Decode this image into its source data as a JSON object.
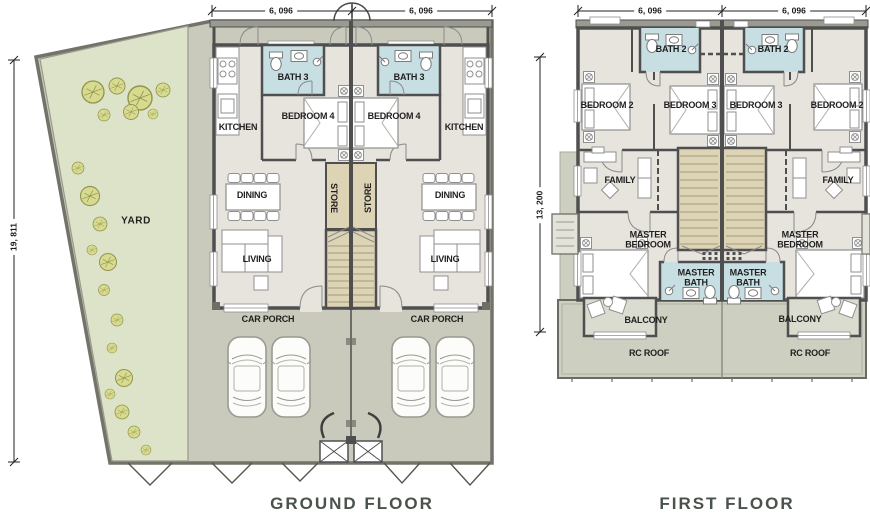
{
  "plans": {
    "ground": {
      "title": "GROUND FLOOR",
      "dim_width_left": "6, 096",
      "dim_width_right": "6, 096",
      "dim_depth": "19, 811",
      "rooms": {
        "yard": "YARD",
        "kitchen": "KITCHEN",
        "bath3": "BATH 3",
        "bedroom4": "BEDROOM 4",
        "dining": "DINING",
        "store": "STORE",
        "living": "LIVING",
        "car_porch": "CAR PORCH"
      }
    },
    "first": {
      "title": "FIRST FLOOR",
      "dim_width_left": "6, 096",
      "dim_width_right": "6, 096",
      "dim_depth": "13, 200",
      "rooms": {
        "bath2": "BATH 2",
        "bedroom2": "BEDROOM 2",
        "bedroom3": "BEDROOM 3",
        "family": "FAMILY",
        "master_bedroom": "MASTER BEDROOM",
        "master_bath": "MASTER BATH",
        "balcony": "BALCONY",
        "rc_roof": "RC ROOF"
      }
    }
  },
  "icons": {
    "tree": "tree-symbol",
    "car": "car-symbol",
    "toilet": "toilet-symbol",
    "sink": "sink-symbol",
    "shower": "shower-symbol"
  },
  "colors": {
    "wall": "#4f4f4f",
    "site_line": "#73736a",
    "apron": "#c9cabb",
    "yard": "#dde3c8",
    "tree_fill": "#d7db90",
    "tree_line": "#93944e",
    "floor": "#e7e4de",
    "bath": "#c7dfe2",
    "tan": "#ddd4b6",
    "tread": "#a39a7f",
    "rc_roof": "#cdcfc0",
    "balcony_floor": "#dadcd0",
    "furniture": "#8f8f8f",
    "label": "#1f1f1f",
    "title": "#49524b",
    "dim": "#1a1a1a"
  }
}
